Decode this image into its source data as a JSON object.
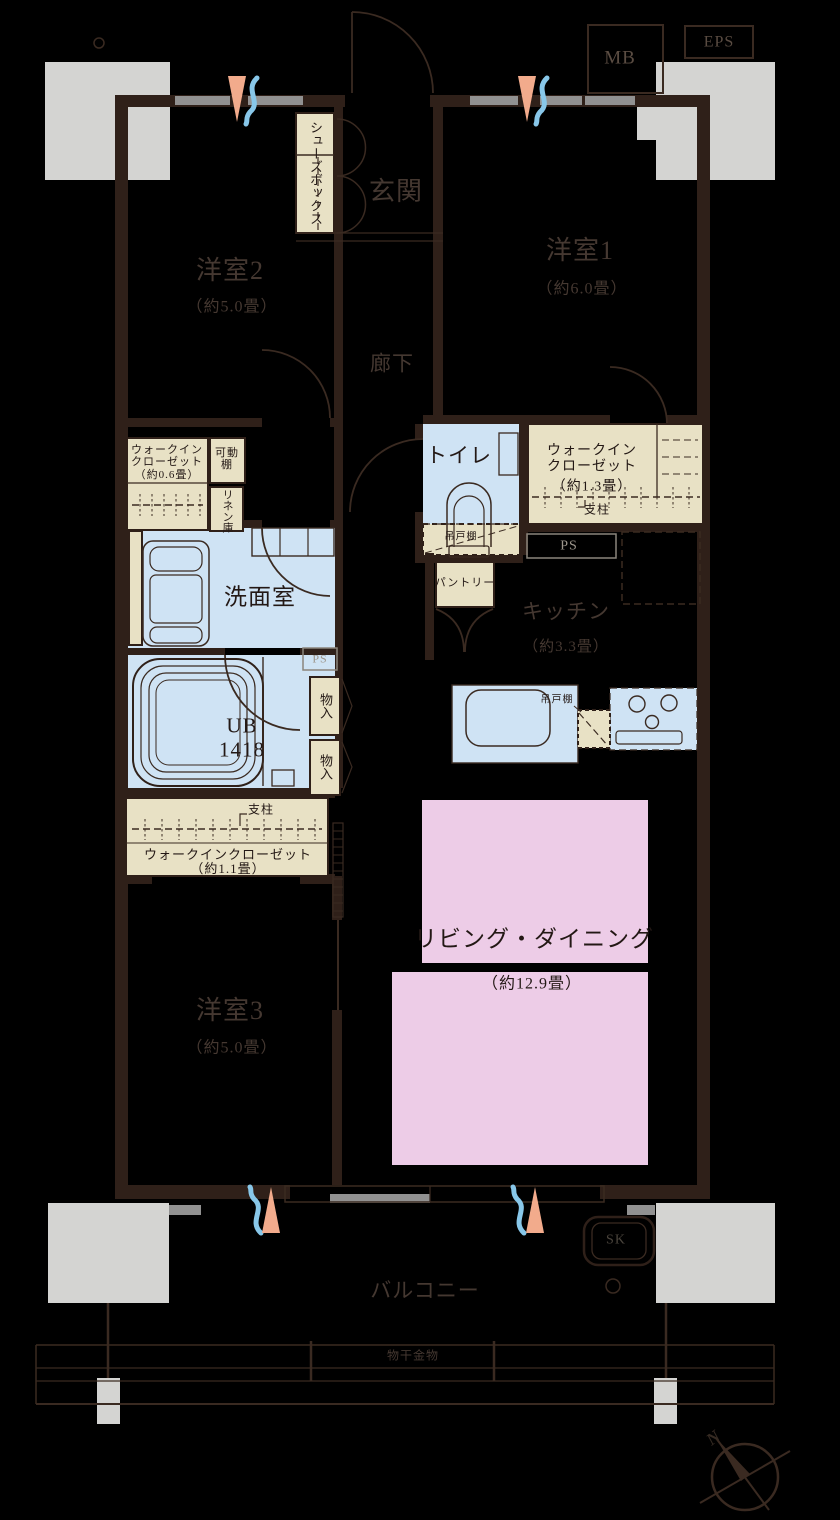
{
  "colors": {
    "bg": "#000000",
    "wall": "#2f2019",
    "line": "#3a2a21",
    "pillar": "#d4d4d2",
    "window": "#919191",
    "beige": "#e8e1c5",
    "blue": "#cfe3f4",
    "blue_light": "#e9f3fa",
    "pink": "#edcce7",
    "text_dark": "#231815",
    "text_room": "#453831",
    "text_shaft": "#5a4c42",
    "text_ps": "#9d968c",
    "vent_orange": "#f2ab8c",
    "vent_blue": "#88c7e9"
  },
  "rooms": {
    "genkan": {
      "label": "玄関"
    },
    "rouka": {
      "label": "廊下"
    },
    "yoshitsu1": {
      "label": "洋室1",
      "size": "（約6.0畳）"
    },
    "yoshitsu2": {
      "label": "洋室2",
      "size": "（約5.0畳）"
    },
    "yoshitsu3": {
      "label": "洋室3",
      "size": "（約5.0畳）"
    },
    "toilet": {
      "label": "トイレ"
    },
    "senmenshitsu": {
      "label": "洗面室"
    },
    "ub": {
      "label": "UB",
      "size": "1418"
    },
    "kitchen": {
      "label": "キッチン",
      "size": "（約3.3畳）"
    },
    "living_dining": {
      "label": "リビング・ダイニング",
      "size": "（約12.9畳）"
    },
    "balcony": {
      "label": "バルコニー"
    }
  },
  "storage": {
    "shoes_box": {
      "label": "シューズボックス"
    },
    "wic06": {
      "line1": "ウォークイン",
      "line2": "クローゼット",
      "size": "（約0.6畳）"
    },
    "wic13": {
      "line1": "ウォークイン",
      "line2": "クローゼット",
      "size": "（約1.3畳）",
      "shichu": "支柱"
    },
    "wic11": {
      "label": "ウォークインクローゼット",
      "size": "（約1.1畳）",
      "shichu": "支柱"
    },
    "kadou_tana": {
      "label": "可動棚"
    },
    "linen_ko": {
      "label": "リネン庫"
    },
    "monoire_upper": {
      "label": "物入"
    },
    "monoire_lower": {
      "label": "物入"
    },
    "pantry": {
      "label": "パントリー"
    },
    "tsuritodana_toilet": {
      "label": "吊戸棚"
    },
    "tsuritodana_kitchen": {
      "label": "吊戸棚"
    }
  },
  "shafts": {
    "mb": "MB",
    "eps": "EPS",
    "ps_kitchen": "PS",
    "ps_bath": "PS",
    "sk": "SK"
  },
  "balcony_items": {
    "monohoshi": "物干金物"
  },
  "compass": {
    "north": "N"
  }
}
